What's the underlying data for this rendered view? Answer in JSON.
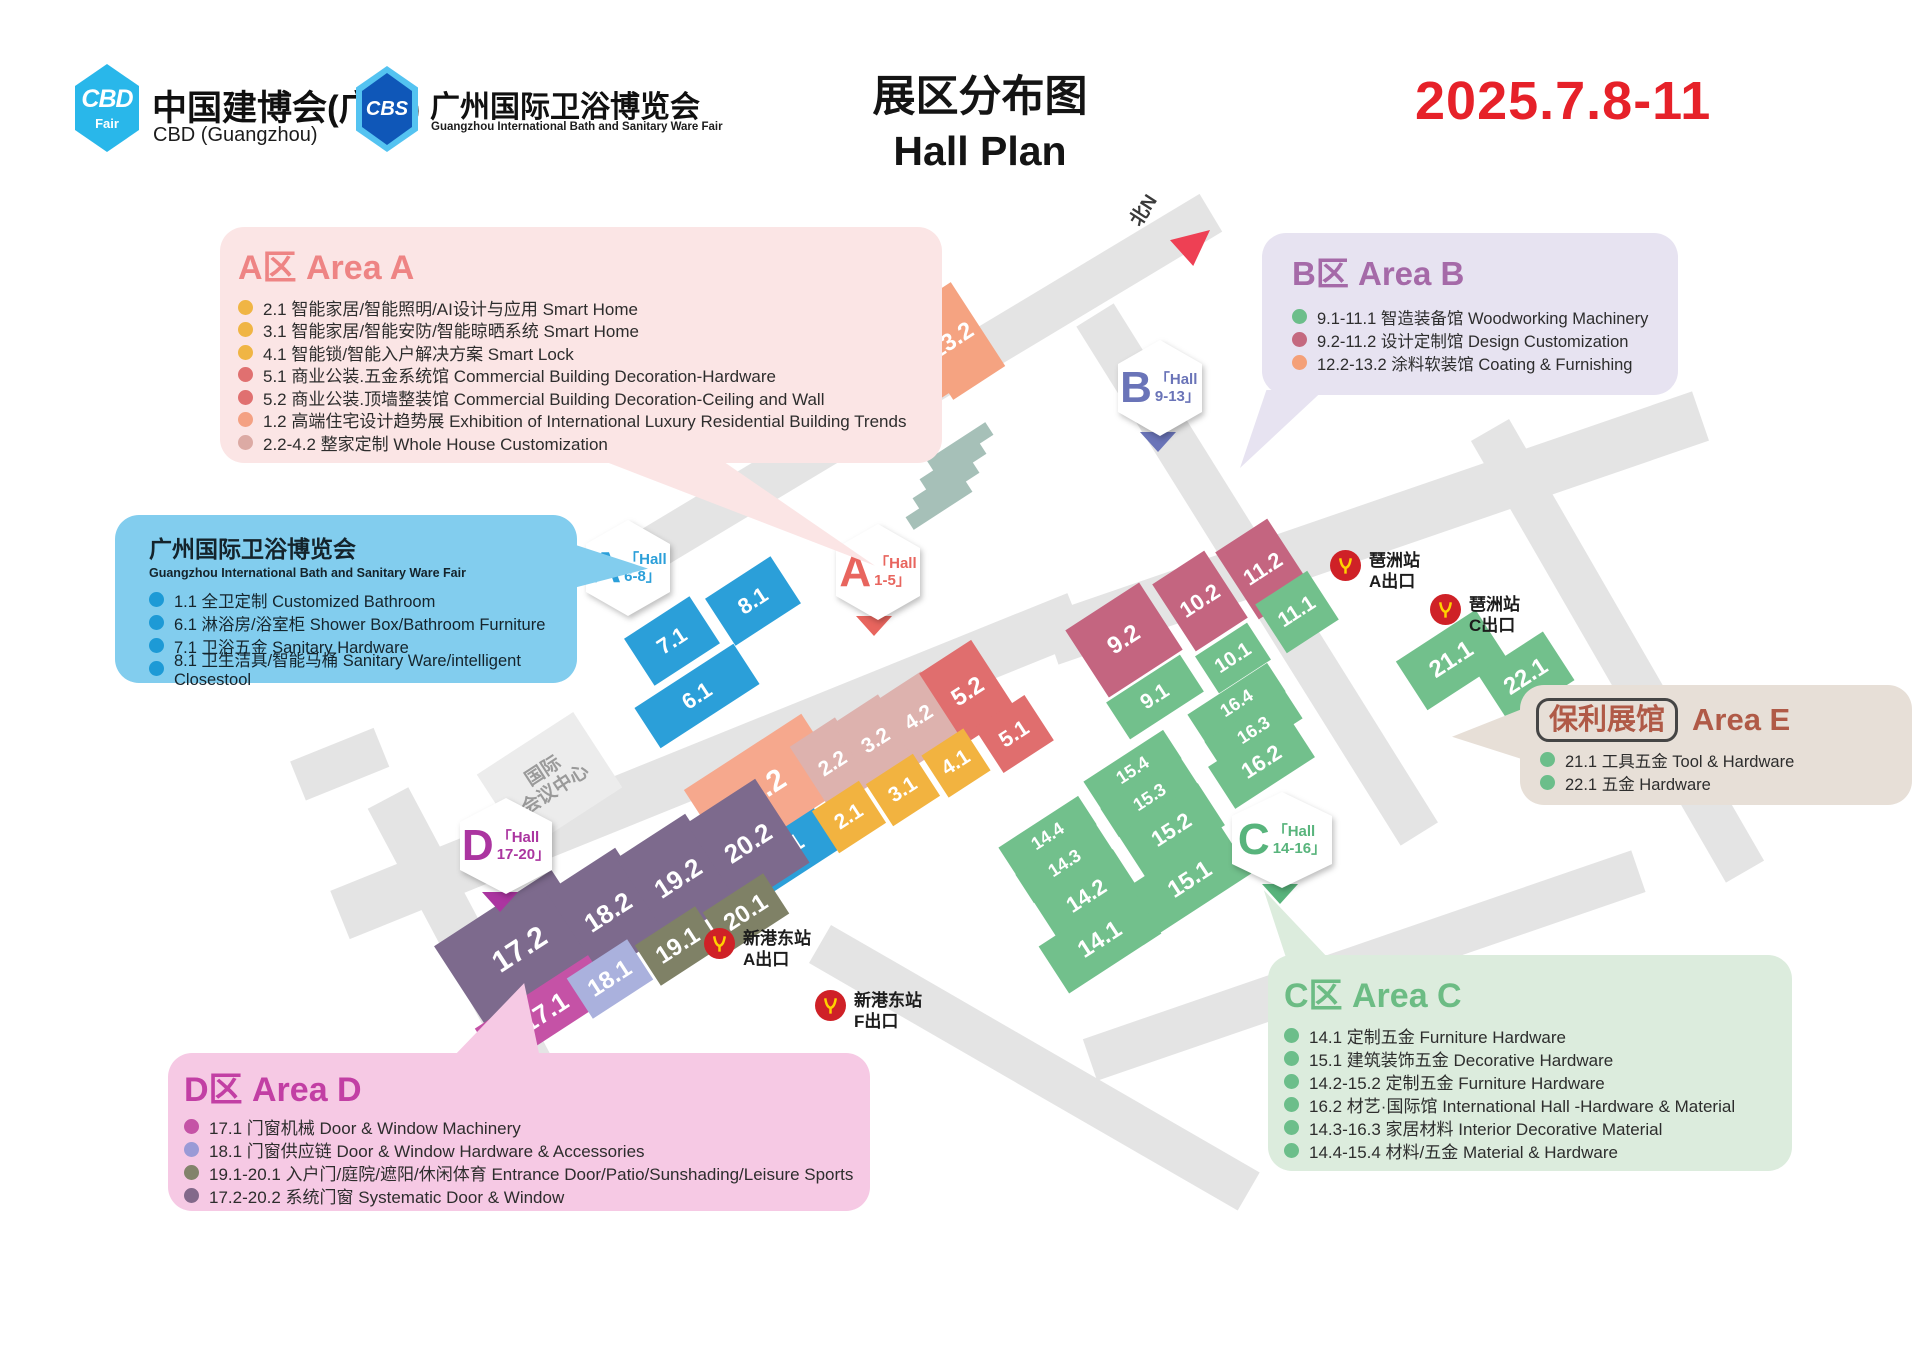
{
  "header": {
    "cbd_abbr": "CBD",
    "cbd_fair": "Fair",
    "cbd_title": "中国建博会(广州)",
    "cbd_subtitle": "CBD (Guangzhou)",
    "cbs_abbr": "CBS",
    "cbs_title": "广州国际卫浴博览会",
    "cbs_subtitle": "Guangzhou International Bath and Sanitary Ware Fair",
    "title_cn": "展区分布图",
    "title_en": "Hall Plan",
    "date": "2025.7.8-11",
    "date_color": "#e62129"
  },
  "map": {
    "north_label": "北N",
    "conference": {
      "line1": "国际",
      "line2": "会议中心"
    },
    "hexagons": [
      {
        "letter": "A",
        "hall": "「Hall",
        "range": "6-8」",
        "color": "#2b9fd9"
      },
      {
        "letter": "A",
        "hall": "「Hall",
        "range": "1-5」",
        "color": "#e8655e"
      },
      {
        "letter": "B",
        "hall": "「Hall",
        "range": "9-13」",
        "color": "#6a74b8"
      },
      {
        "letter": "C",
        "hall": "「Hall",
        "range": "14-16」",
        "color": "#58b47c"
      },
      {
        "letter": "D",
        "hall": "「Hall",
        "range": "17-20」",
        "color": "#ab35a0"
      }
    ],
    "stations": [
      {
        "name": "琶洲站",
        "exit": "A出口"
      },
      {
        "name": "琶洲站",
        "exit": "C出口"
      },
      {
        "name": "新港东站",
        "exit": "A出口"
      },
      {
        "name": "新港东站",
        "exit": "F出口"
      }
    ],
    "halls": [
      {
        "label": "7.1",
        "color": "#2b9fd9"
      },
      {
        "label": "8.1",
        "color": "#2b9fd9"
      },
      {
        "label": "6.1",
        "color": "#2b9fd9"
      },
      {
        "label": "1.1",
        "color": "#2b9fd9"
      },
      {
        "label": "1.2",
        "color": "#f6a88d"
      },
      {
        "label": "2.2",
        "color": "#ddb2ae"
      },
      {
        "label": "3.2",
        "color": "#ddb2ae"
      },
      {
        "label": "4.2",
        "color": "#ddb2ae"
      },
      {
        "label": "5.2",
        "color": "#e06e6e"
      },
      {
        "label": "5.1",
        "color": "#e06e6e"
      },
      {
        "label": "2.1",
        "color": "#f2b340"
      },
      {
        "label": "3.1",
        "color": "#f2b340"
      },
      {
        "label": "4.1",
        "color": "#f2b340"
      },
      {
        "label": "12.2",
        "color": "#f5a381"
      },
      {
        "label": "13.2",
        "color": "#f5a381"
      },
      {
        "label": "9.2",
        "color": "#c46580"
      },
      {
        "label": "10.2",
        "color": "#c46580"
      },
      {
        "label": "11.2",
        "color": "#c46580"
      },
      {
        "label": "9.1",
        "color": "#72c08c"
      },
      {
        "label": "10.1",
        "color": "#72c08c"
      },
      {
        "label": "11.1",
        "color": "#72c08c"
      },
      {
        "label": "21.1",
        "color": "#72c08c"
      },
      {
        "label": "22.1",
        "color": "#72c08c"
      },
      {
        "label": "16.4",
        "color": "#72c08c"
      },
      {
        "label": "16.3",
        "color": "#72c08c"
      },
      {
        "label": "16.2",
        "color": "#72c08c"
      },
      {
        "label": "15.4",
        "color": "#72c08c"
      },
      {
        "label": "15.3",
        "color": "#72c08c"
      },
      {
        "label": "15.2",
        "color": "#72c08c"
      },
      {
        "label": "15.1",
        "color": "#72c08c"
      },
      {
        "label": "14.4",
        "color": "#72c08c"
      },
      {
        "label": "14.3",
        "color": "#72c08c"
      },
      {
        "label": "14.2",
        "color": "#72c08c"
      },
      {
        "label": "14.1",
        "color": "#72c08c"
      },
      {
        "label": "17.2",
        "color": "#7d6a8d"
      },
      {
        "label": "18.2",
        "color": "#7d6a8d"
      },
      {
        "label": "19.2",
        "color": "#7d6a8d"
      },
      {
        "label": "20.2",
        "color": "#7d6a8d"
      },
      {
        "label": "17.1",
        "color": "#c552a6"
      },
      {
        "label": "18.1",
        "color": "#aab1dd"
      },
      {
        "label": "19.1",
        "color": "#7f8166"
      },
      {
        "label": "20.1",
        "color": "#7f8166"
      }
    ]
  },
  "areas": {
    "a": {
      "title": "A区 Area A",
      "accent": "#ee8484",
      "items": [
        {
          "text": "2.1 智能家居/智能照明/AI设计与应用 Smart Home",
          "color": "#f0b544"
        },
        {
          "text": "3.1 智能家居/智能安防/智能晾晒系统 Smart Home",
          "color": "#f0b544"
        },
        {
          "text": "4.1 智能锁/智能入户解决方案 Smart Lock",
          "color": "#f0b544"
        },
        {
          "text": "5.1 商业公装.五金系统馆 Commercial Building Decoration-Hardware",
          "color": "#e07070"
        },
        {
          "text": "5.2 商业公装.顶墙整装馆 Commercial Building Decoration-Ceiling and Wall",
          "color": "#e07070"
        },
        {
          "text": "1.2 高端住宅设计趋势展 Exhibition of International Luxury Residential Building Trends",
          "color": "#f4a183"
        },
        {
          "text": "2.2-4.2 整家定制 Whole House Customization",
          "color": "#dcaaa4"
        }
      ]
    },
    "b": {
      "title": "B区 Area B",
      "accent": "#a56aa8",
      "items": [
        {
          "text": "9.1-11.1 智造装备馆 Woodworking Machinery",
          "color": "#6cbe8a"
        },
        {
          "text": "9.2-11.2 设计定制馆 Design Customization",
          "color": "#c4697f"
        },
        {
          "text": "12.2-13.2 涂料软装馆 Coating & Furnishing",
          "color": "#f4a078"
        }
      ]
    },
    "bath": {
      "title": "广州国际卫浴博览会",
      "subtitle": "Guangzhou International Bath and Sanitary Ware Fair",
      "items": [
        {
          "text": "1.1 全卫定制 Customized Bathroom",
          "color": "#1d9ad6"
        },
        {
          "text": "6.1 淋浴房/浴室柜 Shower Box/Bathroom Furniture",
          "color": "#1d9ad6"
        },
        {
          "text": "7.1 卫浴五金 Sanitary Hardware",
          "color": "#1d9ad6"
        },
        {
          "text": "8.1 卫生洁具/智能马桶 Sanitary Ware/intelligent Closestool",
          "color": "#1d9ad6"
        }
      ]
    },
    "e": {
      "pill": "保利展馆",
      "title": "Area E",
      "accent": "#b05a47",
      "items": [
        {
          "text": "21.1 工具五金 Tool & Hardware",
          "color": "#6cbe8a"
        },
        {
          "text": "22.1 五金 Hardware",
          "color": "#6cbe8a"
        }
      ]
    },
    "c": {
      "title": "C区 Area C",
      "accent": "#6cbc84",
      "items": [
        {
          "text": "14.1 定制五金 Furniture Hardware",
          "color": "#6cbe8a"
        },
        {
          "text": "15.1 建筑装饰五金 Decorative Hardware",
          "color": "#6cbe8a"
        },
        {
          "text": "14.2-15.2 定制五金 Furniture Hardware",
          "color": "#6cbe8a"
        },
        {
          "text": "16.2 材艺·国际馆 International Hall -Hardware & Material",
          "color": "#6cbe8a"
        },
        {
          "text": "14.3-16.3 家居材料 Interior Decorative Material",
          "color": "#6cbe8a"
        },
        {
          "text": "14.4-15.4 材料/五金 Material & Hardware",
          "color": "#6cbe8a"
        }
      ]
    },
    "d": {
      "title": "D区 Area D",
      "accent": "#c23fa4",
      "items": [
        {
          "text": "17.1 门窗机械  Door & Window Machinery",
          "color": "#c553a6"
        },
        {
          "text": "18.1 门窗供应链  Door & Window Hardware & Accessories",
          "color": "#9a9ad6"
        },
        {
          "text": "19.1-20.1 入户门/庭院/遮阳/休闲体育 Entrance Door/Patio/Sunshading/Leisure Sports",
          "color": "#82836b"
        },
        {
          "text": "17.2-20.2 系统门窗 Systematic Door & Window",
          "color": "#82698a"
        }
      ]
    }
  }
}
